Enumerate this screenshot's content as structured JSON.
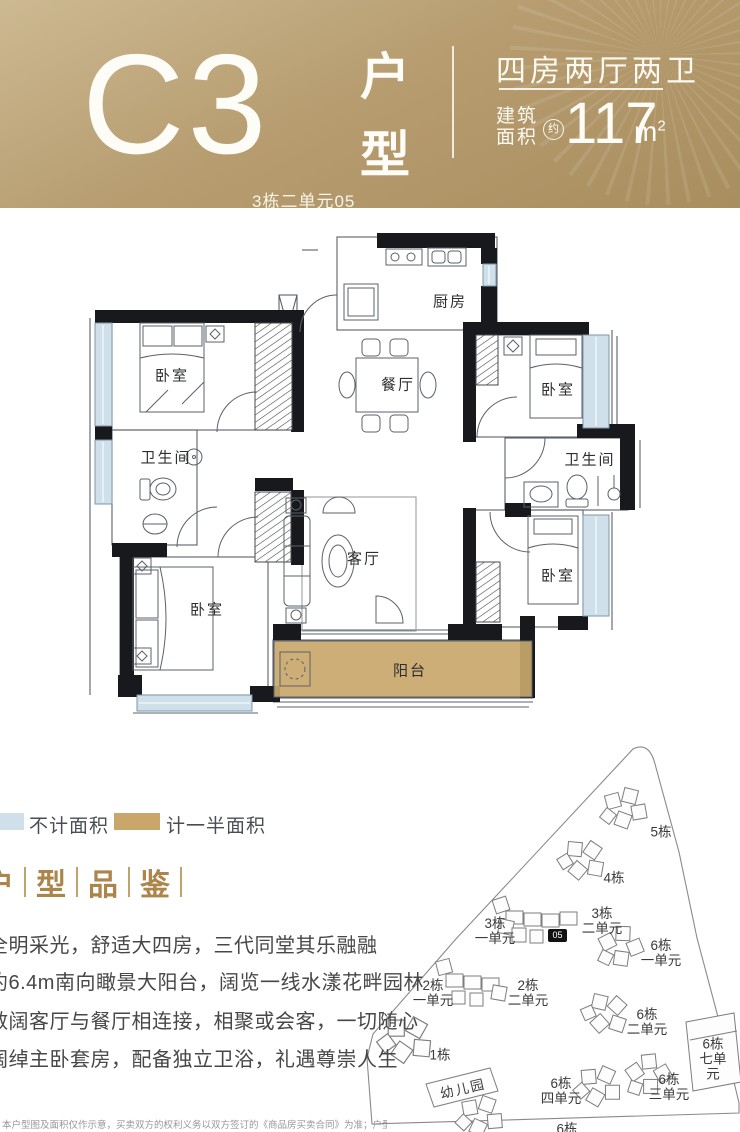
{
  "header": {
    "code": "C3",
    "code_sub": "3栋二单元05",
    "section_vertical": [
      "户",
      "型"
    ],
    "spec": "四房两厅两卫",
    "area_label": "建筑\n面积",
    "area_approx": "约",
    "area_value": "117",
    "area_unit": "m",
    "area_exp": "2"
  },
  "plan": {
    "rooms": {
      "kitchen": "厨房",
      "dining": "餐厅",
      "living": "客厅",
      "balcony": "阳台",
      "bedroom": "卧室",
      "bathroom": "卫生间"
    }
  },
  "legend": {
    "items": [
      {
        "label": "不计面积",
        "color": "#cfe0ea"
      },
      {
        "label": "计一半面积",
        "color": "#c9a76b"
      }
    ]
  },
  "section_title": {
    "chars": [
      "户",
      "型",
      "品",
      "鉴"
    ]
  },
  "features": [
    "全明采光，舒适大四房，三代同堂其乐融融",
    "约6.4m南向瞰景大阳台，阔览一线水漾花畔园林",
    "敞阔客厅与餐厅相连接，相聚或会客，一切随心",
    "阔绰主卧套房，配备独立卫浴，礼遇尊崇人生"
  ],
  "disclaimer": "本户型图及面积仅作示意，买卖双方的权利义务以双方签订的《商品房买卖合同》为准；户型图所标尺寸",
  "sitemap": {
    "badge": "05",
    "labels": {
      "b5": "5栋",
      "b4": "4栋",
      "b3u1": "3栋\n一单元",
      "b3u2": "3栋\n二单元",
      "b6u1": "6栋\n一单元",
      "b2u1": "2栋\n一单元",
      "b2u2": "2栋\n二单元",
      "b6u2": "6栋\n二单元",
      "b6u7": "6栋\n七单元",
      "b1": "1栋",
      "kindergarten": "幼儿园",
      "b6u4": "6栋\n四单元",
      "b6u3": "6栋\n三单元",
      "b6partial": "6栋"
    }
  },
  "colors": {
    "header_gold_light": "#cdb992",
    "header_gold_dark": "#a98e5f",
    "window_blue": "#cfe0ea",
    "balcony_tan": "#c9a76b",
    "wall_black": "#17191c",
    "accent_gold": "#ac854b"
  }
}
